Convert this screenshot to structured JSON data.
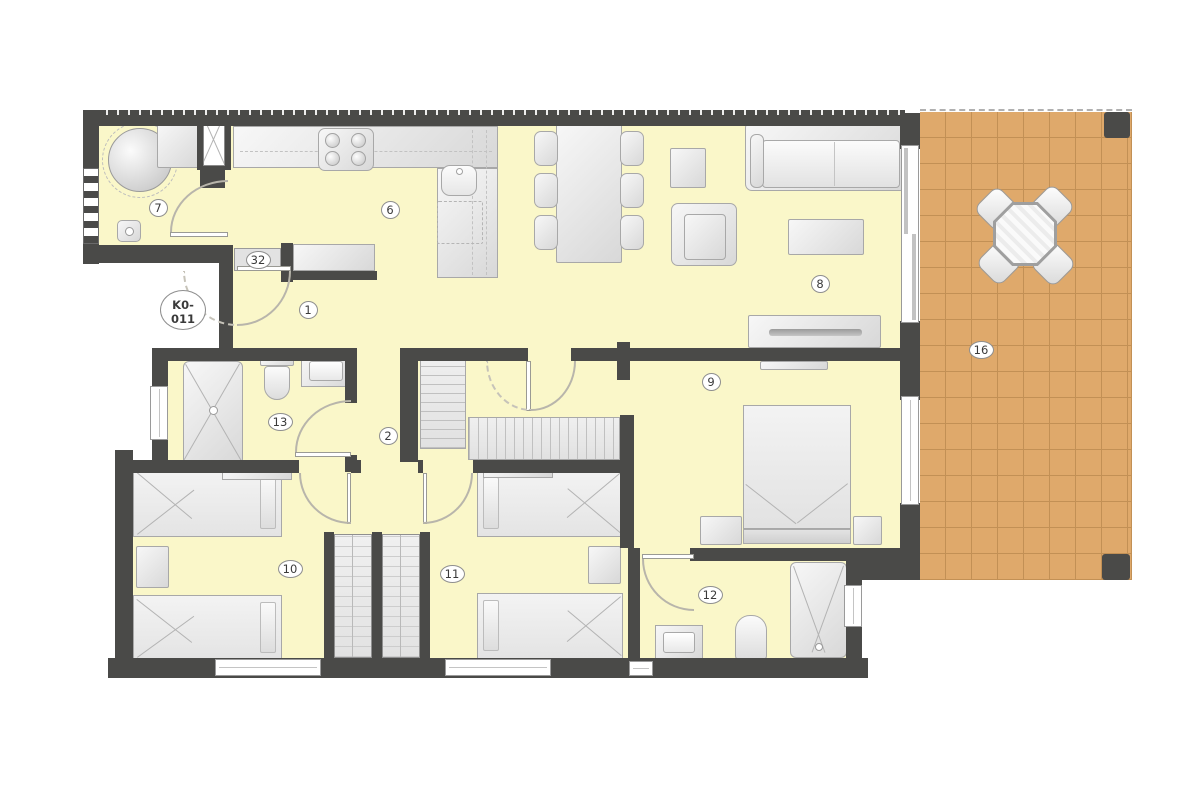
{
  "plan": {
    "unit_label_line1": "K0-",
    "unit_label_line2": "011",
    "rooms": [
      {
        "id": "entrance-hall",
        "label": "1",
        "x": 308,
        "y": 310
      },
      {
        "id": "hallway",
        "label": "2",
        "x": 388,
        "y": 436
      },
      {
        "id": "kitchen",
        "label": "6",
        "x": 390,
        "y": 210
      },
      {
        "id": "utility-room",
        "label": "7",
        "x": 158,
        "y": 208
      },
      {
        "id": "living-room",
        "label": "8",
        "x": 820,
        "y": 284
      },
      {
        "id": "bedroom-master",
        "label": "9",
        "x": 711,
        "y": 382
      },
      {
        "id": "bedroom-2",
        "label": "10",
        "x": 290,
        "y": 569
      },
      {
        "id": "bedroom-3",
        "label": "11",
        "x": 452,
        "y": 574
      },
      {
        "id": "bathroom-ensuite",
        "label": "12",
        "x": 710,
        "y": 595
      },
      {
        "id": "bathroom",
        "label": "13",
        "x": 280,
        "y": 422
      },
      {
        "id": "terrace",
        "label": "16",
        "x": 981,
        "y": 350
      },
      {
        "id": "entrance-door",
        "label": "32",
        "x": 258,
        "y": 260
      }
    ],
    "colors": {
      "wall": "#4a4a48",
      "floor": "#faf7c9",
      "terrace": "#dfa96b",
      "terrace_grid": "#c29055",
      "furniture_border": "#a8a8a8",
      "outline": "#999999"
    }
  }
}
